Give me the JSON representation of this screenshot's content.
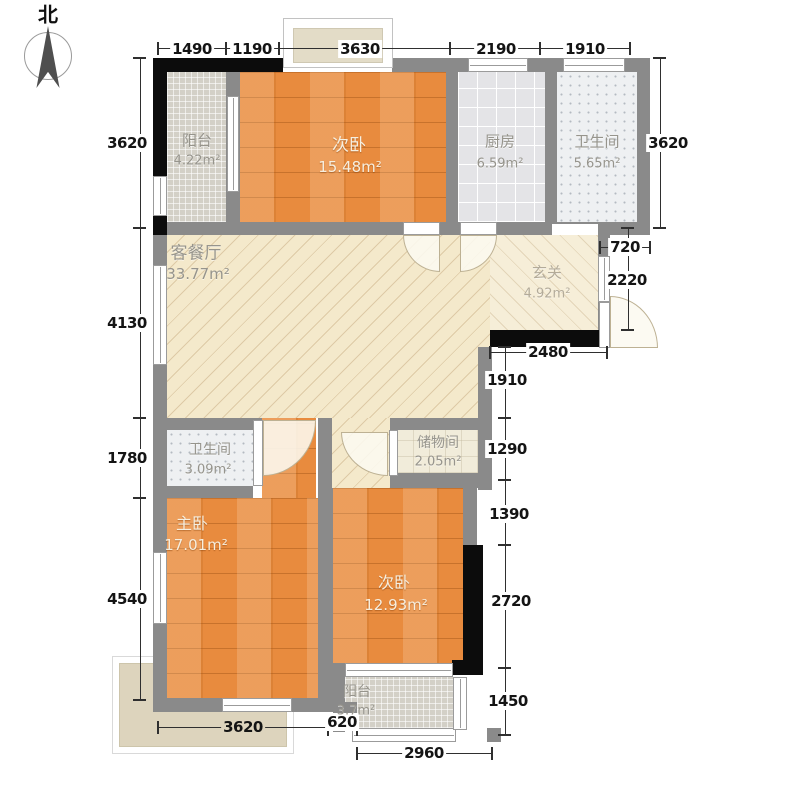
{
  "compass": {
    "north_label": "北"
  },
  "rooms": [
    {
      "key": "balcony_top",
      "name": "阳台",
      "area": "4.22m²"
    },
    {
      "key": "bedroom_top",
      "name": "次卧",
      "area": "15.48m²"
    },
    {
      "key": "kitchen",
      "name": "厨房",
      "area": "6.59m²"
    },
    {
      "key": "bathroom_top",
      "name": "卫生间",
      "area": "5.65m²"
    },
    {
      "key": "living_dining",
      "name": "客餐厅",
      "area": "33.77m²"
    },
    {
      "key": "foyer",
      "name": "玄关",
      "area": "4.92m²"
    },
    {
      "key": "bathroom_bottom",
      "name": "卫生间",
      "area": "3.09m²"
    },
    {
      "key": "storage",
      "name": "储物间",
      "area": "2.05m²"
    },
    {
      "key": "master_bedroom",
      "name": "主卧",
      "area": "17.01m²"
    },
    {
      "key": "bedroom_bottom",
      "name": "次卧",
      "area": "12.93m²"
    },
    {
      "key": "balcony_bottom",
      "name": "阳台",
      "area": "3.7m²"
    }
  ],
  "dimensions": {
    "top": [
      "1490",
      "1190",
      "3630",
      "2190",
      "1910"
    ],
    "left": [
      "3620",
      "4130",
      "1780",
      "4540"
    ],
    "right_outer": [
      "3620",
      "720",
      "2220"
    ],
    "right_inner": [
      "2480",
      "1910",
      "1290",
      "1390",
      "2720",
      "1450"
    ],
    "bottom": [
      "3620",
      "620",
      "2960"
    ]
  },
  "colors": {
    "wood_floor": "#e88b3e",
    "living_floor": "#f4e9cb",
    "wall": "#8a8a8a",
    "wall_dark": "#0c0c0c",
    "bath_tile": "#eef0f2",
    "kitchen_tile": "#e4e4e7",
    "balcony_tile": "#d3d0c7",
    "storage_floor": "#f1ecda",
    "terrace": "#ddd4bd",
    "dim_text": "#141414"
  }
}
